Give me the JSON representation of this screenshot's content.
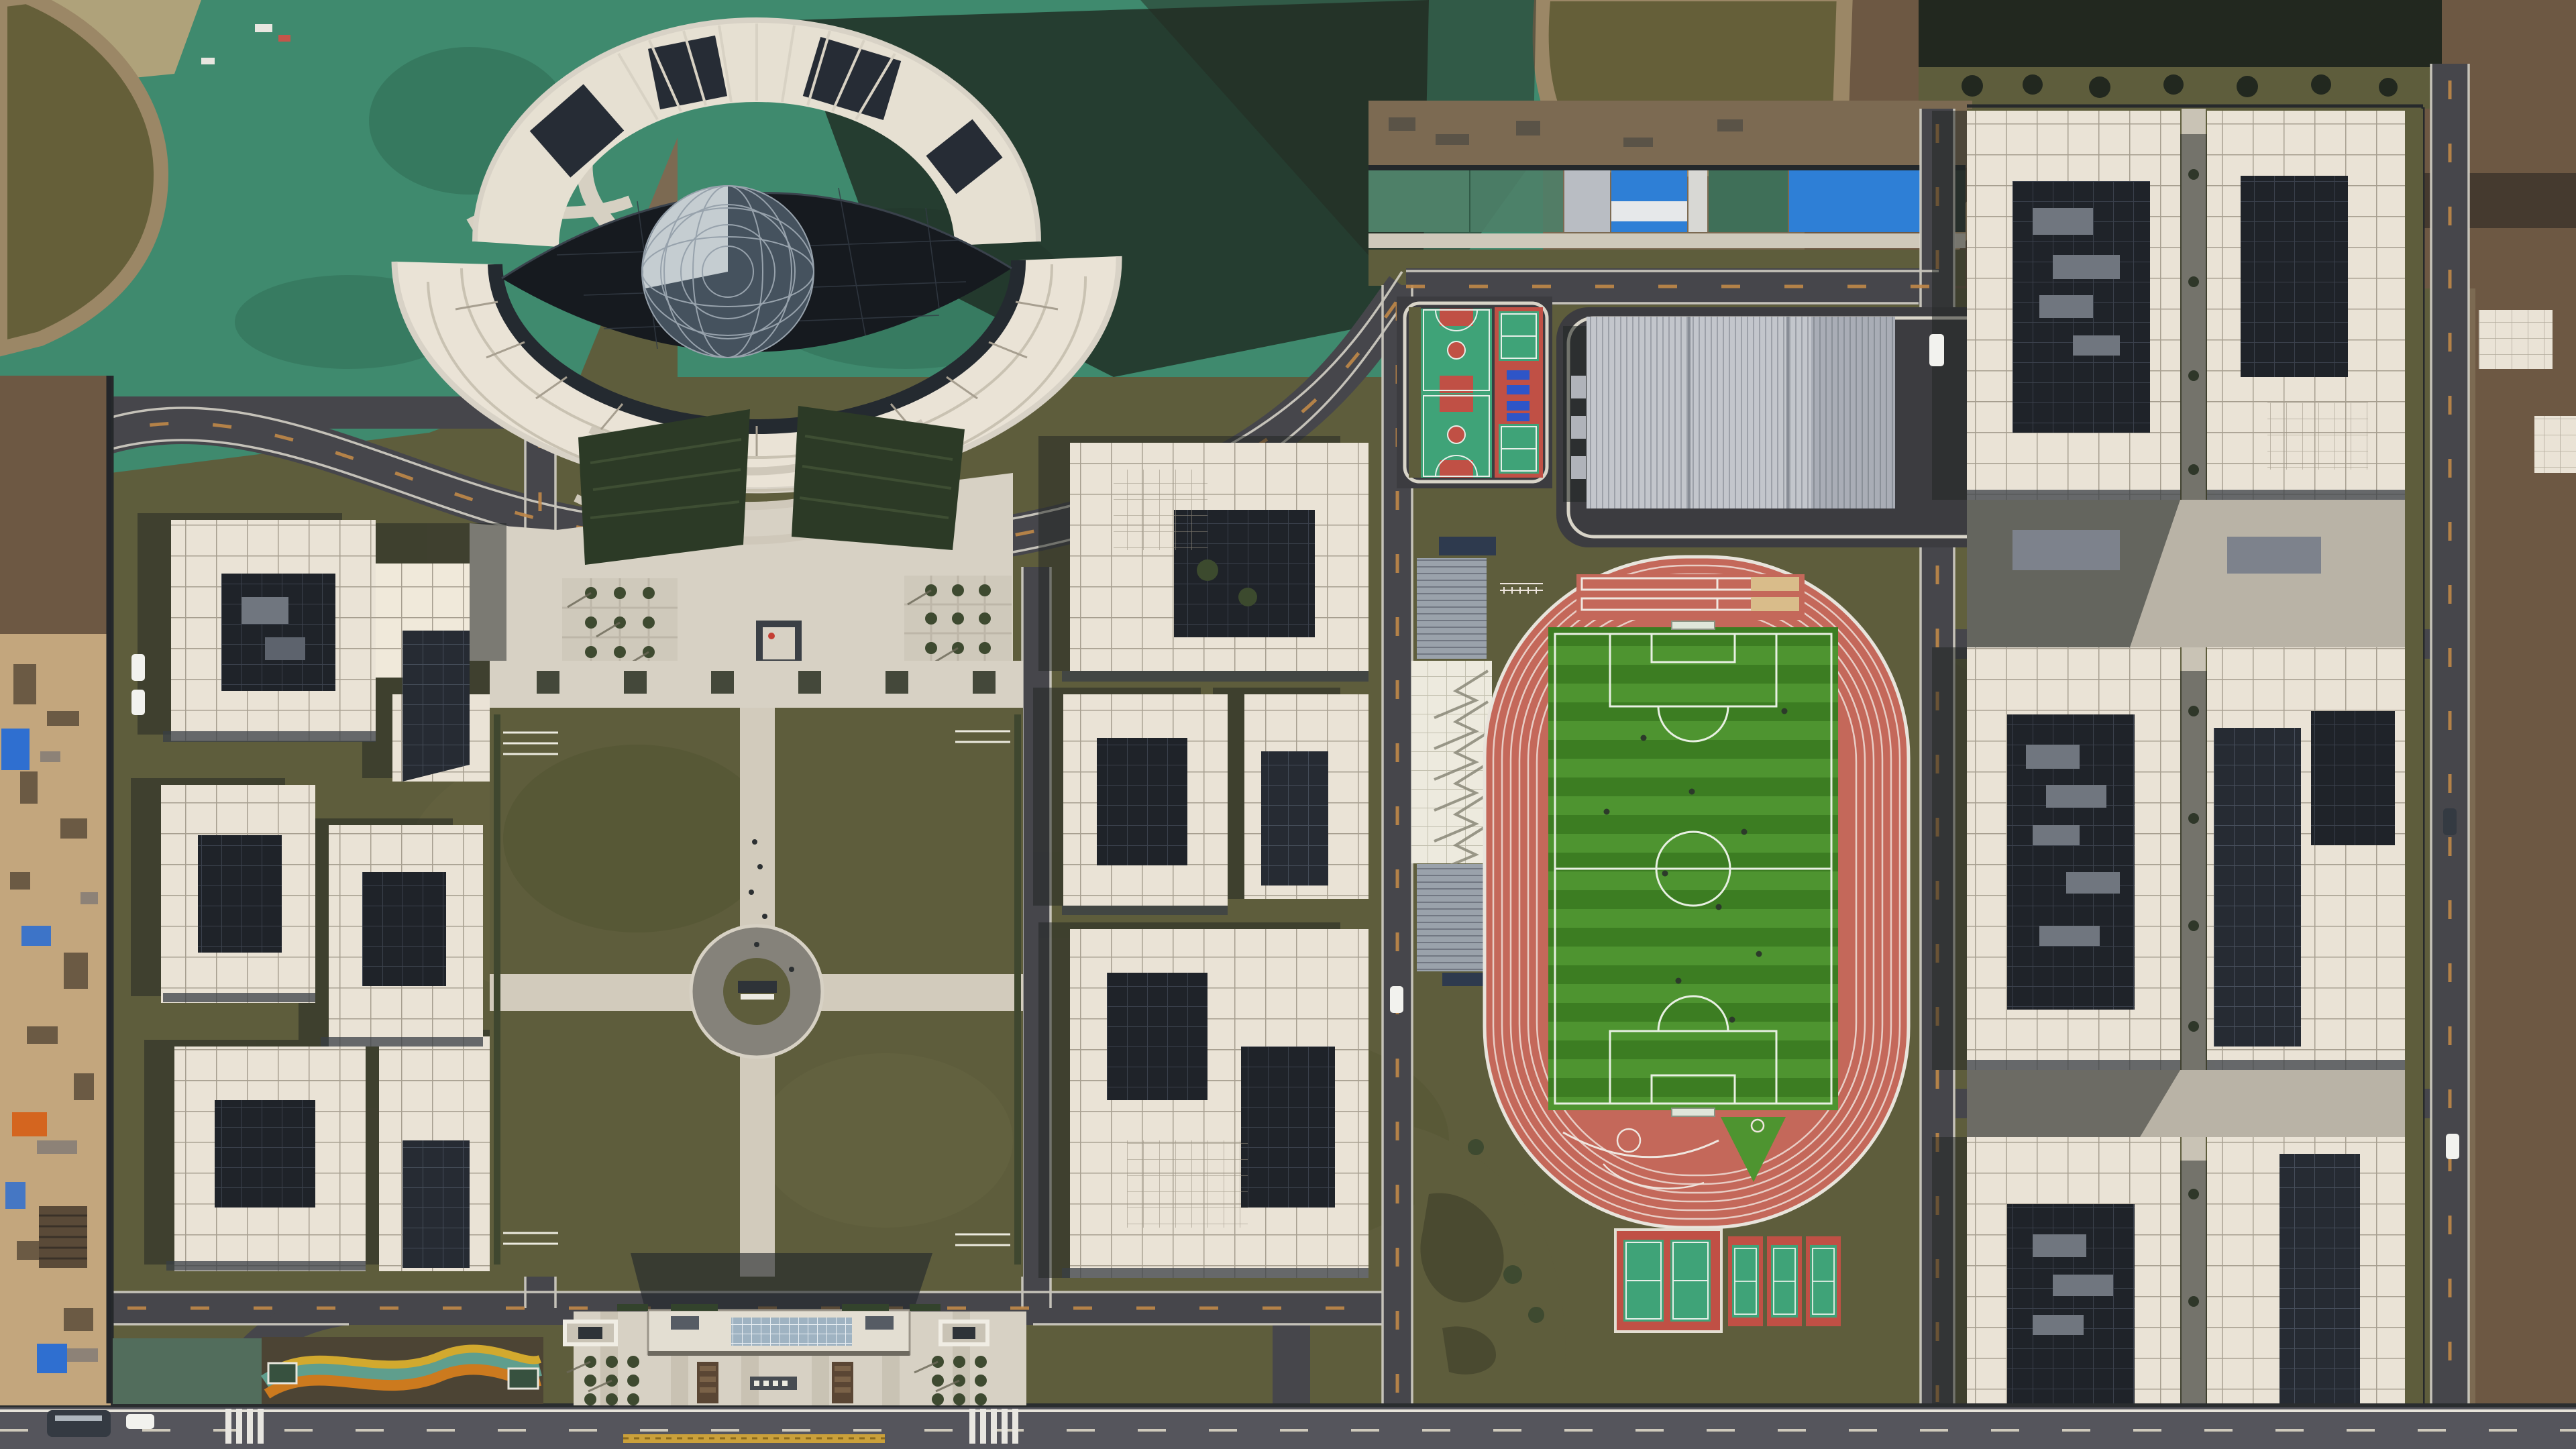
{
  "scene": {
    "title": "Aerial view of a newly built school campus",
    "type": "aerial-photograph",
    "time_of_day": "daytime"
  },
  "regions": {
    "eye_building": {
      "label": "eye-shaped library building under construction with geodesic sphere"
    },
    "ponds": {
      "label": "muddy retention ponds and green erosion netting"
    },
    "left_cluster": {
      "label": "west academic building cluster with white grid roofs"
    },
    "center_cluster": {
      "label": "central academic building cluster"
    },
    "right_cluster": {
      "label": "east dormitory building cluster"
    },
    "quad": {
      "label": "central lawn quad with cross paths and circular plaza"
    },
    "forecourt": {
      "label": "terraced forecourt plaza with tree grids"
    },
    "sports": {
      "label": "sports complex: track, soccer pitch, courts, gymnasium, grandstand"
    },
    "entrance": {
      "label": "south entrance gate building and plaza"
    },
    "staging": {
      "label": "construction staging yard with tarps and materials"
    },
    "roads": {
      "label": "campus ring roads with lane markings"
    },
    "vehicles": {
      "label": "parked vehicles and pedestrians"
    }
  },
  "colors": {
    "ground_dirt": "#7c6a52",
    "dirt_light": "#c3a67d",
    "field_brown": "#6d5843",
    "soil_dark": "#3a332a",
    "netting": "#3f8a6e",
    "netting_dark": "#2f6b54",
    "foliage_dark": "#22281f",
    "pond": "#655f39",
    "bank": "#9b8766",
    "asphalt": "#46464b",
    "asphalt_light": "#55555c",
    "road_edge": "#dcd8cd",
    "dash_orange": "#c08848",
    "paving": "#d7d1c4",
    "paving_dark": "#c0b9aa",
    "lawn": "#5e5d3c",
    "lawn_light": "#6a6843",
    "lawn_dark": "#50512f",
    "roof_white": "#eae3d6",
    "roof_grid": "#a79f90",
    "roof_cream": "#f0e9da",
    "glass_dark": "#262b33",
    "glass_grid": "#4d5563",
    "courtyard": "#1f2329",
    "shadow": "#1f2422",
    "gym_roof": "#c3c6cc",
    "gym_roof_dark": "#a9adb6",
    "stand_gray": "#9aa2ab",
    "tent_white": "#edeade",
    "navy_roof": "#2e3a4e",
    "track": "#c4685a",
    "track_light": "#d07a6a",
    "lane": "#efdfd8",
    "pitch_light": "#4e9430",
    "pitch_dark": "#3c7d22",
    "pitch_line": "#e8f0e2",
    "court_green": "#3fa378",
    "court_red": "#c05045",
    "court_line": "#e6efe8",
    "table_blue": "#2e55c8",
    "sand": "#d9bc8a",
    "tarp_blue": "#2f6fd0",
    "tarp_orange": "#d4651f",
    "flower_orange": "#cc7a1e",
    "flower_yellow": "#d2a92e",
    "garden_teal": "#5f9e8d",
    "soil_garden": "#4c4434",
    "gold_fence": "#caa03a",
    "vehicle_white": "#f2f2ee",
    "vehicle_dark": "#343a42",
    "sphere": "#45525e",
    "sphere_light": "#d3dade",
    "lattice": "#97a2ac",
    "constr_green": "#4e8068",
    "constr_blue": "#2e7fd6",
    "constr_gray": "#b9bdc3"
  }
}
